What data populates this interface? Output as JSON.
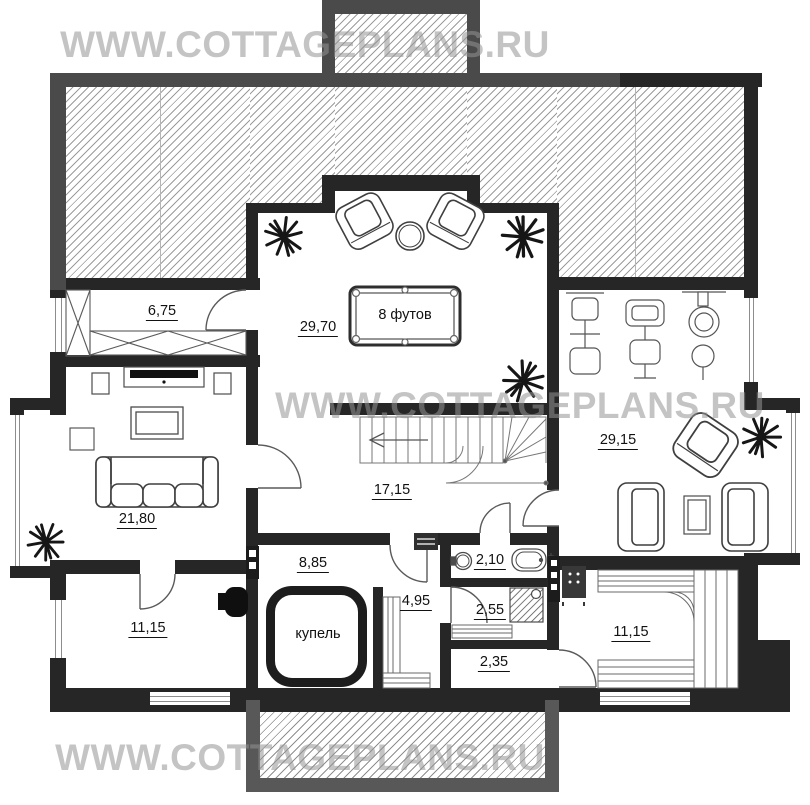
{
  "watermark": {
    "text": "WWW.COTTAGEPLANS.RU"
  },
  "colors": {
    "wall": "#262626",
    "roof_band": "#4a4a4a",
    "terrace_band": "#585858",
    "hatch_line": "#9c9c9c",
    "label": "#111111",
    "watermark": "#949494"
  },
  "rooms": [
    {
      "name": "wardrobe",
      "text": "6,75",
      "x": 162,
      "y": 312,
      "underline": true
    },
    {
      "name": "billiard-room",
      "text": "29,70",
      "x": 318,
      "y": 328,
      "underline": true
    },
    {
      "name": "billiard-table-size",
      "text": "8 футов",
      "x": 405,
      "y": 315,
      "underline": false
    },
    {
      "name": "stair-hall",
      "text": "17,15",
      "x": 392,
      "y": 491,
      "underline": true
    },
    {
      "name": "gym-lounge",
      "text": "29,15",
      "x": 618,
      "y": 441,
      "underline": true
    },
    {
      "name": "living-room",
      "text": "21,80",
      "x": 137,
      "y": 520,
      "underline": true
    },
    {
      "name": "storage-left",
      "text": "11,15",
      "x": 148,
      "y": 629,
      "underline": true
    },
    {
      "name": "pool-room",
      "text": "8,85",
      "x": 313,
      "y": 564,
      "underline": true
    },
    {
      "name": "bathroom",
      "text": "2,10",
      "x": 490,
      "y": 561,
      "underline": true
    },
    {
      "name": "steam-anteroom",
      "text": "4,95",
      "x": 416,
      "y": 602,
      "underline": true
    },
    {
      "name": "shower-room",
      "text": "2,55",
      "x": 490,
      "y": 611,
      "underline": true
    },
    {
      "name": "vestibule",
      "text": "2,35",
      "x": 494,
      "y": 663,
      "underline": true
    },
    {
      "name": "sauna",
      "text": "11,15",
      "x": 631,
      "y": 633,
      "underline": true
    },
    {
      "name": "plunge-pool",
      "text": "купель",
      "x": 318,
      "y": 634,
      "underline": false
    }
  ]
}
